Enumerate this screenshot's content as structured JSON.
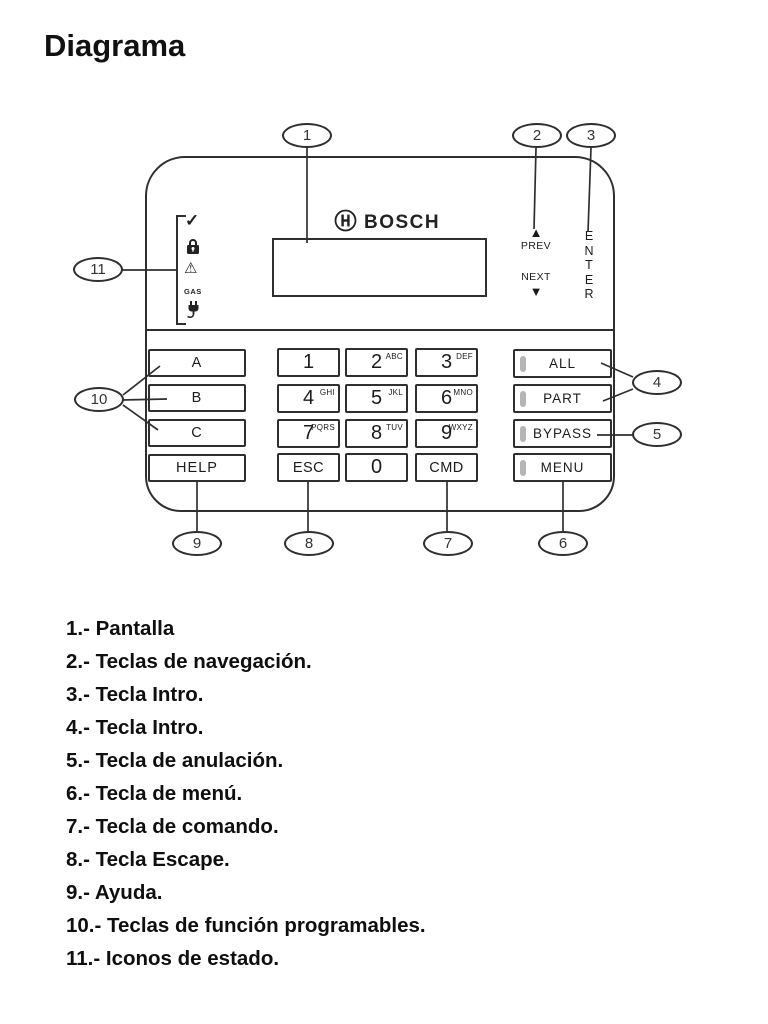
{
  "title": "Diagrama",
  "device": {
    "brand": "BOSCH",
    "nav": {
      "prev": "PREV",
      "next": "NEXT",
      "prev_arrow": "▲",
      "next_arrow": "▼",
      "enter": "ENTER"
    },
    "status_icons": {
      "check": "✓",
      "warning": "⚠",
      "gas": "GAS"
    },
    "function_keys": [
      "A",
      "B",
      "C",
      "HELP"
    ],
    "numpad": [
      {
        "digit": "1",
        "letters": ""
      },
      {
        "digit": "2",
        "letters": "ABC"
      },
      {
        "digit": "3",
        "letters": "DEF"
      },
      {
        "digit": "4",
        "letters": "GHI"
      },
      {
        "digit": "5",
        "letters": "JKL"
      },
      {
        "digit": "6",
        "letters": "MNO"
      },
      {
        "digit": "7",
        "letters": "PQRS"
      },
      {
        "digit": "8",
        "letters": "TUV"
      },
      {
        "digit": "9",
        "letters": "WXYZ"
      },
      {
        "digit": "ESC",
        "letters": ""
      },
      {
        "digit": "0",
        "letters": ""
      },
      {
        "digit": "CMD",
        "letters": ""
      }
    ],
    "right_keys": [
      "ALL",
      "PART",
      "BYPASS",
      "MENU"
    ]
  },
  "callouts": [
    "1",
    "2",
    "3",
    "4",
    "5",
    "6",
    "7",
    "8",
    "9",
    "10",
    "11"
  ],
  "legend": {
    "items": [
      "1.- Pantalla",
      "2.- Teclas de navegación.",
      "3.- Tecla Intro.",
      "4.- Tecla Intro.",
      "5.- Tecla de anulación.",
      "6.- Tecla de menú.",
      "7.- Tecla de comando.",
      "8.- Tecla Escape.",
      "9.- Ayuda.",
      "10.- Teclas de función programables.",
      "11.- Iconos de estado."
    ]
  }
}
